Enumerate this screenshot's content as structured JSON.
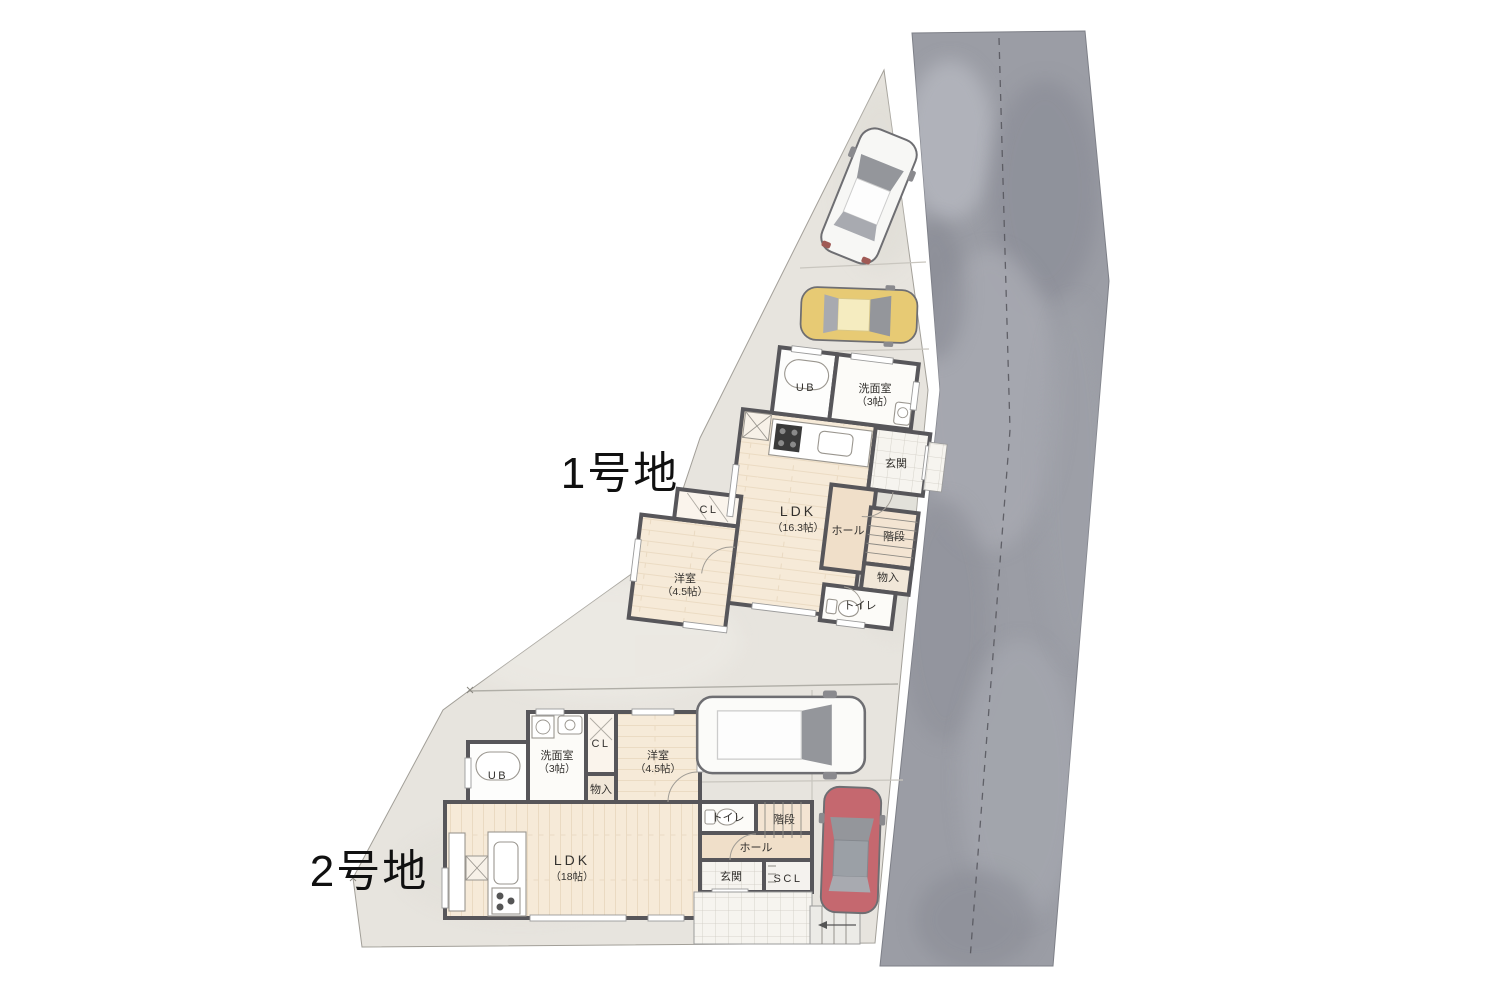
{
  "lot1": {
    "label": "1号地",
    "rooms": {
      "ub": "UB",
      "washroom": "洗面室",
      "washroom_size": "（3帖）",
      "entrance": "玄関",
      "ldk": "LDK",
      "ldk_size": "（16.3帖）",
      "hall": "ホール",
      "stairs": "階段",
      "storage": "物入",
      "toilet": "トイレ",
      "closet": "CL",
      "bedroom": "洋室",
      "bedroom_size": "（4.5帖）"
    }
  },
  "lot2": {
    "label": "2号地",
    "rooms": {
      "ub": "UB",
      "washroom": "洗面室",
      "washroom_size": "（3帖）",
      "closet": "CL",
      "bedroom": "洋室",
      "bedroom_size": "（4.5帖）",
      "storage": "物入",
      "ldk": "LDK",
      "ldk_size": "（18帖）",
      "toilet": "トイレ",
      "stairs": "階段",
      "hall": "ホール",
      "entrance": "玄関",
      "scl": "SCL"
    }
  },
  "colors": {
    "site": "#e7e4de",
    "road": "#9b9da5",
    "wall": "#57565a",
    "wood_floor": "#f6ead8",
    "hall_floor": "#f0dfc9",
    "car_suv": "#f7f7f5",
    "car_compact": "#e7ca74",
    "car_van": "#fbfbf9",
    "car_sedan": "#c5686f"
  }
}
